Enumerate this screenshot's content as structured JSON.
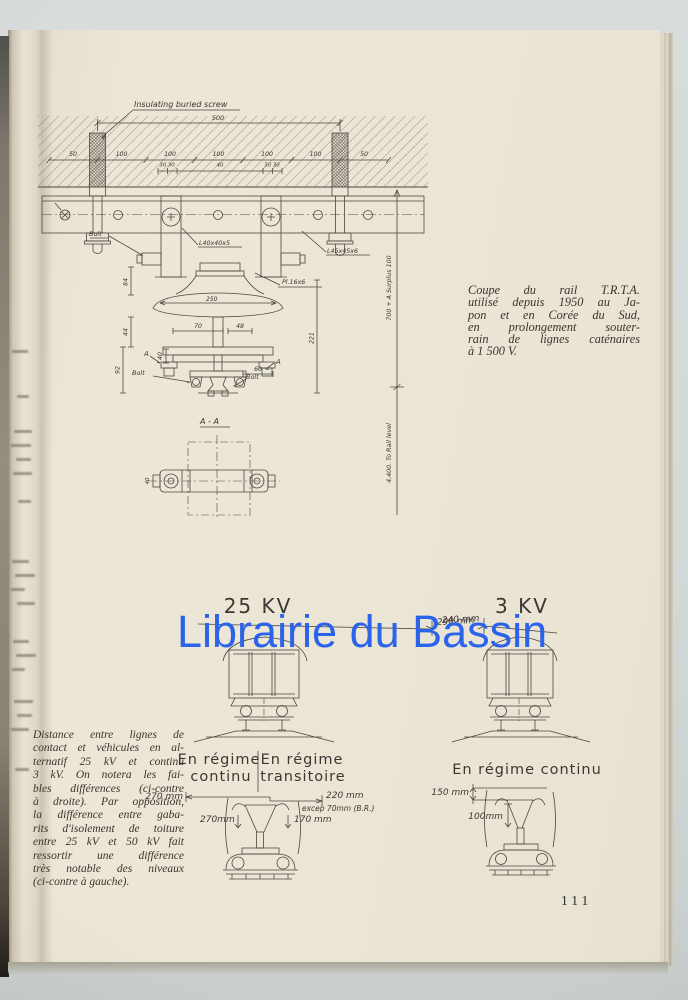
{
  "meta": {
    "description": "Photographed technical book page with rail and pantograph clearance drawings",
    "page_number": "111",
    "colors": {
      "watermark": "#2b63ea",
      "page": "#ebe5d6",
      "backdrop": "#d5d9d8",
      "ink": "#4b4741"
    }
  },
  "watermark": {
    "text": "Librairie du Bassin"
  },
  "rail_drawing": {
    "screw_label": "Insulating buried screw",
    "dim_overall": "500",
    "dim_row": [
      "50",
      "100",
      "100",
      "100",
      "100",
      "100",
      "50"
    ],
    "sub_dim_left": "30 30",
    "sub_dim_center": "40",
    "sub_dim_right": "30 30",
    "label_bolt_upper": "Bolt",
    "label_angle_bracket": "L40x40x5",
    "label_angle_beam": "L45x45x6",
    "label_plate": "Pl.16x6",
    "dim_250": "250",
    "dim_84": "84",
    "dim_44": "44",
    "dim_92": "92",
    "dim_70": "70",
    "dim_48": "48",
    "dim_40": "40",
    "dim_60": "60",
    "dim_221": "221",
    "marker_a_left": "A",
    "marker_a_right": "A",
    "label_bolt_left": "Bolt",
    "label_bolt_right": "Bolt",
    "dim_surplus": "700 + A Surplus 100",
    "dim_rail_level": "4,400. To Rail level",
    "section_title": "A - A",
    "section_dim_40": "40"
  },
  "clearance_diagrams": {
    "left_title": "25 KV",
    "left_clearance": "290 mm",
    "right_title": "3 KV",
    "right_clearance": "240 mm"
  },
  "pantograph_left": {
    "regime1_line1": "En régime",
    "regime1_line2": "continu",
    "regime2_line1": "En régime",
    "regime2_line2": "transitoire",
    "dim_270_top": "270 mm",
    "dim_220": "220 mm",
    "dim_exception": "excep 70mm (B.R.)",
    "dim_270_mid": "270mm",
    "dim_170": "170 mm"
  },
  "pantograph_right": {
    "regime": "En régime continu",
    "dim_150": "150 mm",
    "dim_100": "100mm"
  },
  "caption_right": {
    "lines": [
      "Coupe du rail T.R.T.A.",
      "utilisé depuis 1950 au Ja-",
      "pon et en Corée du Sud,",
      "en prolongement souter-",
      "rain de lignes caténaires",
      "à 1 500 V."
    ]
  },
  "caption_left": {
    "lines": [
      "Distance entre lignes de",
      "contact et véhicules en al-",
      "ternatif 25 kV et continu",
      "3 kV. On notera les fai-",
      "bles différences (ci-contre",
      "à droite). Par opposition,",
      "la différence entre gaba-",
      "rits d'isolement de toiture",
      "entre 25 kV et 50 kV fait",
      "ressortir une différence",
      "très notable des niveaux",
      "(ci-contre à gauche)."
    ]
  },
  "page_number": "111"
}
